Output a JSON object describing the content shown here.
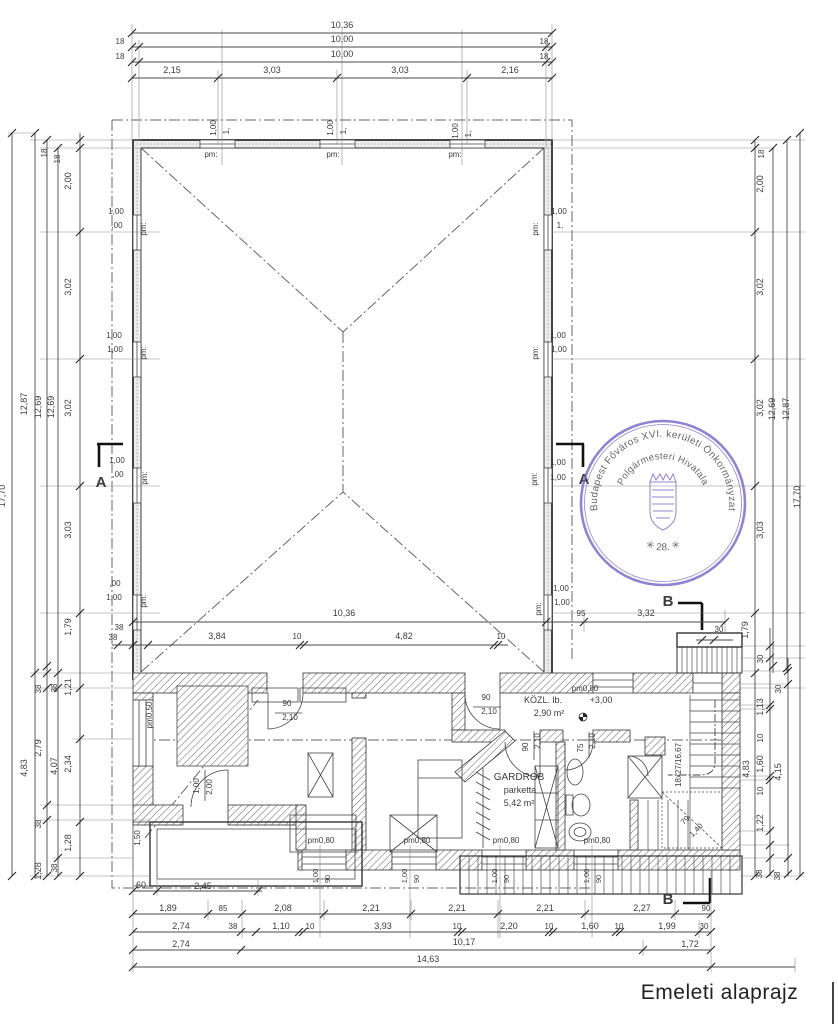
{
  "meta": {
    "title": "Emeleti alaprajz"
  },
  "colors": {
    "ink": "#3b3b3b",
    "faint": "#8a8a8a",
    "stamp": "#6f63c5",
    "paper": "#ffffff"
  },
  "stamp": {
    "outer_text": "Budapest Főváros XVI. kerületi Önkormányzat",
    "inner_text": "Polgármesteri Hivatala",
    "number_text": "✳ 28. ✳"
  },
  "rooms": [
    {
      "name": "KÖZL. lb.",
      "area": "2,90 m²",
      "level": "+3,00"
    },
    {
      "name": "GARDROB",
      "finish": "parketta",
      "area": "5,42 m²"
    }
  ],
  "labels": [
    {
      "t": "10,36",
      "x": 342,
      "y": 28
    },
    {
      "t": "18",
      "x": 120,
      "y": 44,
      "s": 8
    },
    {
      "t": "10,00",
      "x": 342,
      "y": 42
    },
    {
      "t": "18",
      "x": 544,
      "y": 44,
      "s": 8
    },
    {
      "t": "18",
      "x": 120,
      "y": 59,
      "s": 8
    },
    {
      "t": "10,00",
      "x": 342,
      "y": 57
    },
    {
      "t": "18",
      "x": 544,
      "y": 59,
      "s": 8
    },
    {
      "t": "2,15",
      "x": 172,
      "y": 73
    },
    {
      "t": "3,03",
      "x": 272,
      "y": 73
    },
    {
      "t": "3,03",
      "x": 400,
      "y": 73
    },
    {
      "t": "2,16",
      "x": 510,
      "y": 73
    },
    {
      "t": "1,00",
      "x": 216,
      "y": 128,
      "r": -90,
      "s": 8,
      "n": "window-size-label"
    },
    {
      "t": "1,",
      "x": 229,
      "y": 131,
      "r": -90,
      "s": 8,
      "n": "window-size-label"
    },
    {
      "t": "1,00",
      "x": 333,
      "y": 128,
      "r": -90,
      "s": 8,
      "n": "window-size-label"
    },
    {
      "t": "1,",
      "x": 346,
      "y": 131,
      "r": -90,
      "s": 8,
      "n": "window-size-label"
    },
    {
      "t": "1,00",
      "x": 458,
      "y": 131,
      "r": -90,
      "s": 8,
      "n": "window-size-label"
    },
    {
      "t": "1,",
      "x": 471,
      "y": 134,
      "r": -90,
      "s": 8,
      "n": "window-size-label"
    },
    {
      "t": "pm:",
      "x": 211,
      "y": 157,
      "s": 8,
      "n": "parapet-label"
    },
    {
      "t": "pm:",
      "x": 333,
      "y": 157,
      "s": 8,
      "n": "parapet-label"
    },
    {
      "t": "pm:",
      "x": 455,
      "y": 157,
      "s": 8,
      "n": "parapet-label"
    },
    {
      "t": "17,70",
      "x": 5,
      "y": 496,
      "r": -90
    },
    {
      "t": "12,87",
      "x": 27,
      "y": 404,
      "r": -90
    },
    {
      "t": "12,69",
      "x": 41,
      "y": 407,
      "r": -90
    },
    {
      "t": "12,69",
      "x": 54,
      "y": 407,
      "r": -90
    },
    {
      "t": "18",
      "x": 47,
      "y": 153,
      "r": -90,
      "s": 8
    },
    {
      "t": "18",
      "x": 60,
      "y": 159,
      "r": -90,
      "s": 8
    },
    {
      "t": "2,00",
      "x": 71,
      "y": 181,
      "r": -90
    },
    {
      "t": "3,02",
      "x": 71,
      "y": 287,
      "r": -90
    },
    {
      "t": "3,02",
      "x": 71,
      "y": 408,
      "r": -90
    },
    {
      "t": "3,03",
      "x": 71,
      "y": 530,
      "r": -90
    },
    {
      "t": "1,79",
      "x": 71,
      "y": 627,
      "r": -90
    },
    {
      "t": "38",
      "x": 41,
      "y": 689,
      "r": -90,
      "s": 8
    },
    {
      "t": "38",
      "x": 57,
      "y": 688,
      "r": -90,
      "s": 8
    },
    {
      "t": "1,21",
      "x": 71,
      "y": 687,
      "r": -90
    },
    {
      "t": "2,79",
      "x": 41,
      "y": 748,
      "r": -90
    },
    {
      "t": "4,07",
      "x": 57,
      "y": 766,
      "r": -90
    },
    {
      "t": "2,34",
      "x": 71,
      "y": 764,
      "r": -90
    },
    {
      "t": "4,83",
      "x": 27,
      "y": 768,
      "r": -90
    },
    {
      "t": "38",
      "x": 41,
      "y": 824,
      "r": -90,
      "s": 8
    },
    {
      "t": "1,28",
      "x": 71,
      "y": 843,
      "r": -90
    },
    {
      "t": "1,28",
      "x": 41,
      "y": 871,
      "r": -90
    },
    {
      "t": "38",
      "x": 57,
      "y": 868,
      "r": -90,
      "s": 8
    },
    {
      "t": "1,00",
      "x": 116,
      "y": 214,
      "s": 8,
      "n": "window-size-label"
    },
    {
      "t": ",00",
      "x": 117,
      "y": 228,
      "s": 8,
      "n": "window-size-label"
    },
    {
      "t": "pm:",
      "x": 146,
      "y": 229,
      "r": -90,
      "s": 8,
      "n": "parapet-label"
    },
    {
      "t": "1,00",
      "x": 114,
      "y": 338,
      "s": 8,
      "n": "window-size-label"
    },
    {
      "t": "1,00",
      "x": 115,
      "y": 352,
      "s": 8,
      "n": "window-size-label"
    },
    {
      "t": "pm:",
      "x": 146,
      "y": 353,
      "r": -90,
      "s": 8,
      "n": "parapet-label"
    },
    {
      "t": "1,00",
      "x": 117,
      "y": 463,
      "s": 8,
      "n": "window-size-label"
    },
    {
      "t": ",00",
      "x": 118,
      "y": 477,
      "s": 8,
      "n": "window-size-label"
    },
    {
      "t": "pm:",
      "x": 147,
      "y": 478,
      "r": -90,
      "s": 8,
      "n": "parapet-label"
    },
    {
      "t": ",00",
      "x": 115,
      "y": 586,
      "s": 8,
      "n": "window-size-label"
    },
    {
      "t": "1,00",
      "x": 114,
      "y": 600,
      "s": 8,
      "n": "window-size-label"
    },
    {
      "t": "pm:",
      "x": 146,
      "y": 601,
      "r": -90,
      "s": 8,
      "n": "parapet-label"
    },
    {
      "t": "38",
      "x": 119,
      "y": 630,
      "s": 8
    },
    {
      "t": "18",
      "x": 764,
      "y": 154,
      "r": -90,
      "s": 8
    },
    {
      "t": "2,00",
      "x": 763,
      "y": 184,
      "r": -90
    },
    {
      "t": "3,02",
      "x": 763,
      "y": 287,
      "r": -90
    },
    {
      "t": "3,02",
      "x": 763,
      "y": 408,
      "r": -90
    },
    {
      "t": "3,03",
      "x": 763,
      "y": 530,
      "r": -90
    },
    {
      "t": "1,79",
      "x": 748,
      "y": 630,
      "r": -90
    },
    {
      "t": "12,69",
      "x": 775,
      "y": 409,
      "r": -90
    },
    {
      "t": "12,87",
      "x": 789,
      "y": 409,
      "r": -90
    },
    {
      "t": "17,70",
      "x": 800,
      "y": 497,
      "r": -90
    },
    {
      "t": "30",
      "x": 763,
      "y": 659,
      "r": -90,
      "s": 8
    },
    {
      "t": "1,13",
      "x": 763,
      "y": 707,
      "r": -90
    },
    {
      "t": "10",
      "x": 763,
      "y": 738,
      "r": -90,
      "s": 8
    },
    {
      "t": "1,60",
      "x": 763,
      "y": 764,
      "r": -90
    },
    {
      "t": "10",
      "x": 763,
      "y": 791,
      "r": -90,
      "s": 8
    },
    {
      "t": "1,22",
      "x": 763,
      "y": 823,
      "r": -90
    },
    {
      "t": "38",
      "x": 762,
      "y": 874,
      "r": -90,
      "s": 8
    },
    {
      "t": "4,83",
      "x": 749,
      "y": 769,
      "r": -90
    },
    {
      "t": "30",
      "x": 781,
      "y": 689,
      "r": -90,
      "s": 8
    },
    {
      "t": "4,15",
      "x": 781,
      "y": 772,
      "r": -90
    },
    {
      "t": "38",
      "x": 780,
      "y": 876,
      "r": -90,
      "s": 8
    },
    {
      "t": "1,00",
      "x": 559,
      "y": 214,
      "s": 8,
      "n": "window-size-label"
    },
    {
      "t": "1,",
      "x": 560,
      "y": 228,
      "s": 8,
      "n": "window-size-label"
    },
    {
      "t": "pm:",
      "x": 538,
      "y": 229,
      "r": -90,
      "s": 8,
      "n": "parapet-label"
    },
    {
      "t": "1,00",
      "x": 558,
      "y": 338,
      "s": 8,
      "n": "window-size-label"
    },
    {
      "t": "1,00",
      "x": 559,
      "y": 352,
      "s": 8,
      "n": "window-size-label"
    },
    {
      "t": "pm:",
      "x": 538,
      "y": 353,
      "r": -90,
      "s": 8,
      "n": "parapet-label"
    },
    {
      "t": "1,00",
      "x": 558,
      "y": 465,
      "s": 8,
      "n": "window-size-label"
    },
    {
      "t": "1,00",
      "x": 558,
      "y": 480,
      "s": 8,
      "n": "window-size-label"
    },
    {
      "t": "pm:",
      "x": 537,
      "y": 479,
      "r": -90,
      "s": 8,
      "n": "parapet-label"
    },
    {
      "t": "1,00",
      "x": 561,
      "y": 591,
      "s": 8,
      "n": "window-size-label"
    },
    {
      "t": "1,00",
      "x": 562,
      "y": 605,
      "s": 8,
      "n": "window-size-label"
    },
    {
      "t": "pm:",
      "x": 541,
      "y": 609,
      "r": -90,
      "s": 8,
      "n": "parapet-label"
    },
    {
      "t": "10,36",
      "x": 344,
      "y": 616
    },
    {
      "t": "95",
      "x": 581,
      "y": 616,
      "s": 8
    },
    {
      "t": "3,32",
      "x": 646,
      "y": 616
    },
    {
      "t": "38",
      "x": 113,
      "y": 640,
      "s": 8
    },
    {
      "t": "3,84",
      "x": 217,
      "y": 639
    },
    {
      "t": "10",
      "x": 297,
      "y": 639,
      "s": 8
    },
    {
      "t": "4,82",
      "x": 404,
      "y": 639
    },
    {
      "t": "10",
      "x": 501,
      "y": 639,
      "s": 8
    },
    {
      "t": "30",
      "x": 719,
      "y": 632,
      "s": 8
    },
    {
      "t": "A",
      "x": 101,
      "y": 487,
      "s": 15,
      "b": 1,
      "n": "section-marker-label"
    },
    {
      "t": "A",
      "x": 584,
      "y": 484,
      "s": 15,
      "b": 1,
      "n": "section-marker-label"
    },
    {
      "t": "B",
      "x": 668,
      "y": 606,
      "s": 15,
      "b": 1,
      "n": "section-marker-label"
    },
    {
      "t": "B",
      "x": 668,
      "y": 904,
      "s": 15,
      "b": 1,
      "n": "section-marker-label"
    },
    {
      "t": "pm0,50",
      "x": 152,
      "y": 715,
      "r": -90,
      "s": 8,
      "n": "parapet-label"
    },
    {
      "t": "90",
      "x": 287,
      "y": 706,
      "s": 8,
      "n": "door-size-label"
    },
    {
      "t": "2,10",
      "x": 290,
      "y": 720,
      "s": 8,
      "n": "door-size-label"
    },
    {
      "t": "90",
      "x": 486,
      "y": 700,
      "s": 8,
      "n": "door-size-label"
    },
    {
      "t": "2,10",
      "x": 489,
      "y": 714,
      "s": 8,
      "n": "door-size-label"
    },
    {
      "t": "pm0,80",
      "x": 585,
      "y": 691,
      "s": 8,
      "n": "parapet-label"
    },
    {
      "t": "KÖZL. lb.",
      "x": 543,
      "y": 703,
      "s": 9,
      "n": "room-name-label"
    },
    {
      "t": "+3,00",
      "x": 601,
      "y": 703,
      "s": 9,
      "n": "level-label"
    },
    {
      "t": "2,90 m²",
      "x": 549,
      "y": 716,
      "s": 9,
      "n": "room-area-label"
    },
    {
      "t": "90",
      "x": 528,
      "y": 747,
      "r": -90,
      "s": 8,
      "n": "door-size-label"
    },
    {
      "t": "2,10",
      "x": 540,
      "y": 741,
      "r": -90,
      "s": 8,
      "n": "door-size-label"
    },
    {
      "t": "75",
      "x": 583,
      "y": 748,
      "r": -90,
      "s": 8,
      "n": "door-size-label"
    },
    {
      "t": "2,10",
      "x": 595,
      "y": 741,
      "r": -90,
      "s": 8,
      "n": "door-size-label"
    },
    {
      "t": "GARDROB",
      "x": 519,
      "y": 780,
      "s": 10,
      "n": "room-name-label"
    },
    {
      "t": "parketta",
      "x": 520,
      "y": 793,
      "s": 9,
      "n": "room-finish-label"
    },
    {
      "t": "5,42 m²",
      "x": 519,
      "y": 806,
      "s": 9,
      "n": "room-area-label"
    },
    {
      "t": "1,00",
      "x": 199,
      "y": 786,
      "r": -90,
      "s": 8,
      "n": "door-size-label"
    },
    {
      "t": "2,00",
      "x": 212,
      "y": 787,
      "r": -90,
      "s": 8,
      "n": "door-size-label"
    },
    {
      "t": "1,50",
      "x": 140,
      "y": 838,
      "r": -90,
      "s": 8
    },
    {
      "t": "pm0,80",
      "x": 321,
      "y": 843,
      "s": 8,
      "n": "parapet-label"
    },
    {
      "t": "pm0,80",
      "x": 417,
      "y": 843,
      "s": 8,
      "n": "parapet-label"
    },
    {
      "t": "pm0,80",
      "x": 506,
      "y": 843,
      "s": 8,
      "n": "parapet-label"
    },
    {
      "t": "pm0,80",
      "x": 597,
      "y": 843,
      "s": 8,
      "n": "parapet-label"
    },
    {
      "t": "1,00",
      "x": 318,
      "y": 876,
      "r": -90,
      "s": 7.5,
      "n": "window-size-label"
    },
    {
      "t": "90",
      "x": 330,
      "y": 879,
      "r": -90,
      "s": 7.5,
      "n": "window-size-label"
    },
    {
      "t": "1,00",
      "x": 407,
      "y": 876,
      "r": -90,
      "s": 7.5,
      "n": "window-size-label"
    },
    {
      "t": "90",
      "x": 419,
      "y": 879,
      "r": -90,
      "s": 7.5,
      "n": "window-size-label"
    },
    {
      "t": "1,00",
      "x": 497,
      "y": 876,
      "r": -90,
      "s": 7.5,
      "n": "window-size-label"
    },
    {
      "t": "90",
      "x": 509,
      "y": 879,
      "r": -90,
      "s": 7.5,
      "n": "window-size-label"
    },
    {
      "t": "1,00",
      "x": 589,
      "y": 876,
      "r": -90,
      "s": 7.5,
      "n": "window-size-label"
    },
    {
      "t": "90",
      "x": 601,
      "y": 879,
      "r": -90,
      "s": 7.5,
      "n": "window-size-label"
    },
    {
      "t": "18x27/16,67",
      "x": 681,
      "y": 765,
      "r": -90,
      "s": 8,
      "n": "stair-label"
    },
    {
      "t": "79",
      "x": 687,
      "y": 822,
      "r": -45,
      "s": 8,
      "n": "stair-label"
    },
    {
      "t": "1,40",
      "x": 698,
      "y": 832,
      "r": -45,
      "s": 8,
      "n": "stair-label"
    },
    {
      "t": "60",
      "x": 141,
      "y": 888
    },
    {
      "t": "2,45",
      "x": 203,
      "y": 889
    },
    {
      "t": "1,89",
      "x": 168,
      "y": 911
    },
    {
      "t": "85",
      "x": 223,
      "y": 911,
      "s": 8
    },
    {
      "t": "2,08",
      "x": 283,
      "y": 911
    },
    {
      "t": "2,21",
      "x": 371,
      "y": 911
    },
    {
      "t": "2,21",
      "x": 457,
      "y": 911
    },
    {
      "t": "2,21",
      "x": 545,
      "y": 911
    },
    {
      "t": "2,27",
      "x": 642,
      "y": 911
    },
    {
      "t": "90",
      "x": 706,
      "y": 911,
      "s": 8
    },
    {
      "t": "2,74",
      "x": 181,
      "y": 929
    },
    {
      "t": "38",
      "x": 233,
      "y": 929,
      "s": 8
    },
    {
      "t": "1,10",
      "x": 281,
      "y": 929
    },
    {
      "t": "10",
      "x": 310,
      "y": 929,
      "s": 8
    },
    {
      "t": "3,93",
      "x": 383,
      "y": 929
    },
    {
      "t": "10",
      "x": 457,
      "y": 929,
      "s": 8
    },
    {
      "t": "2,20",
      "x": 509,
      "y": 929
    },
    {
      "t": "10",
      "x": 549,
      "y": 929,
      "s": 8
    },
    {
      "t": "1,60",
      "x": 590,
      "y": 929
    },
    {
      "t": "10",
      "x": 619,
      "y": 929,
      "s": 8
    },
    {
      "t": "1,99",
      "x": 667,
      "y": 929
    },
    {
      "t": "30",
      "x": 704,
      "y": 929,
      "s": 8
    },
    {
      "t": "2,74",
      "x": 181,
      "y": 947
    },
    {
      "t": "10,17",
      "x": 464,
      "y": 945
    },
    {
      "t": "1,72",
      "x": 690,
      "y": 947
    },
    {
      "t": "14,63",
      "x": 428,
      "y": 962
    }
  ],
  "dim_lines": [
    {
      "o": "h",
      "c": 33,
      "a": 132,
      "b": 552,
      "t": [
        132,
        552
      ]
    },
    {
      "o": "h",
      "c": 47,
      "a": 132,
      "b": 552,
      "t": [
        132,
        139,
        546,
        552
      ]
    },
    {
      "o": "h",
      "c": 62,
      "a": 132,
      "b": 552,
      "t": [
        132,
        139,
        546,
        552
      ]
    },
    {
      "o": "h",
      "c": 78,
      "a": 132,
      "b": 552,
      "t": [
        132,
        218,
        337,
        467,
        552
      ]
    },
    {
      "o": "h",
      "c": 622,
      "a": 133,
      "b": 725,
      "t": [
        133,
        546,
        584,
        725
      ]
    },
    {
      "o": "h",
      "c": 645,
      "a": 112,
      "b": 508,
      "t": [
        118,
        133,
        148,
        300,
        304,
        494,
        498
      ]
    },
    {
      "o": "h",
      "c": 640,
      "a": 696,
      "b": 733,
      "t": [
        702,
        714
      ]
    },
    {
      "o": "h",
      "c": 891,
      "a": 133,
      "b": 262,
      "t": [
        133,
        157,
        258
      ]
    },
    {
      "o": "h",
      "c": 914,
      "a": 133,
      "b": 711,
      "t": [
        133,
        208,
        242,
        324,
        411,
        498,
        585,
        675,
        711
      ]
    },
    {
      "o": "h",
      "c": 932,
      "a": 133,
      "b": 711,
      "t": [
        133,
        241,
        256,
        299,
        303,
        458,
        462,
        549,
        553,
        616,
        620,
        699,
        711
      ]
    },
    {
      "o": "h",
      "c": 950,
      "a": 133,
      "b": 711,
      "t": [
        133,
        241,
        643,
        711
      ]
    },
    {
      "o": "h",
      "c": 967,
      "a": 133,
      "b": 795,
      "t": [
        133,
        711
      ]
    },
    {
      "o": "v",
      "c": 12,
      "a": 133,
      "b": 876,
      "t": [
        133,
        876
      ]
    },
    {
      "o": "v",
      "c": 35,
      "a": 133,
      "b": 876,
      "t": [
        133,
        673,
        876
      ]
    },
    {
      "o": "v",
      "c": 47,
      "a": 140,
      "b": 876,
      "t": [
        140,
        666,
        673,
        688,
        805,
        820,
        876
      ]
    },
    {
      "o": "v",
      "c": 58,
      "a": 148,
      "b": 876,
      "t": [
        148,
        673,
        688,
        858,
        876
      ]
    },
    {
      "o": "v",
      "c": 80,
      "a": 133,
      "b": 876,
      "t": [
        140,
        148,
        232,
        359,
        486,
        613,
        688,
        739,
        822,
        876
      ]
    },
    {
      "o": "v",
      "c": 755,
      "a": 140,
      "b": 876,
      "t": [
        140,
        148,
        232,
        359,
        486,
        613,
        673,
        876
      ]
    },
    {
      "o": "v",
      "c": 770,
      "a": 628,
      "b": 876,
      "t": [
        646,
        658,
        705,
        709,
        776,
        780,
        831,
        845,
        858,
        874
      ]
    },
    {
      "o": "v",
      "c": 788,
      "a": 658,
      "b": 876,
      "t": [
        671,
        684,
        858,
        874
      ]
    },
    {
      "o": "v",
      "c": 800,
      "a": 133,
      "b": 876,
      "t": [
        133,
        876
      ]
    },
    {
      "o": "v",
      "c": 773,
      "a": 148,
      "b": 673,
      "t": [
        148,
        666
      ]
    },
    {
      "o": "v",
      "c": 787,
      "a": 140,
      "b": 673,
      "t": [
        140,
        668
      ]
    }
  ]
}
